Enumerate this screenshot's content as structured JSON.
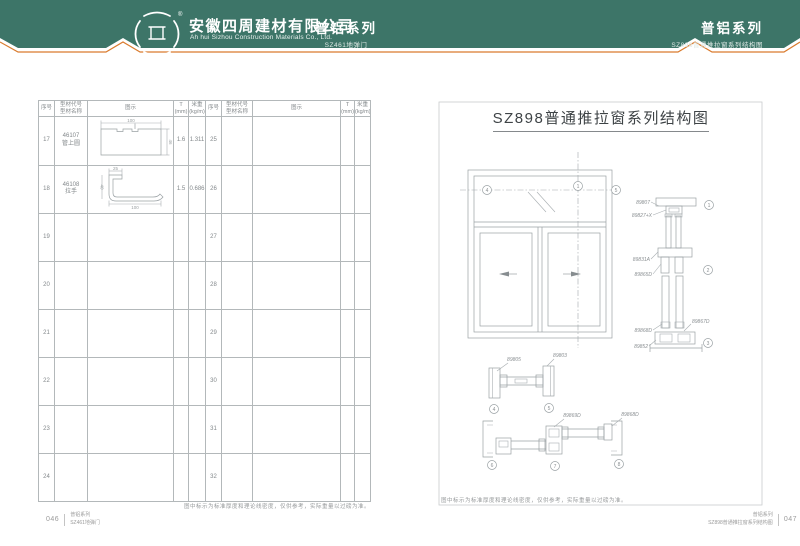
{
  "header": {
    "green": "#3D7568",
    "accent": "#D97B2E",
    "logo_registered": "®",
    "company_name": "安徽四周建材有限公司",
    "company_name_en": "Ah hui Sizhou Construction Materials Co., Ltd.",
    "center": {
      "series": "普铝系列",
      "sub": "SZ461地弹门"
    },
    "right": {
      "series": "普铝系列",
      "sub": "SZ898普通推拉窗系列结构图"
    }
  },
  "left_page": {
    "table": {
      "headers": {
        "no": "序号",
        "code": "型材代号",
        "name": "型材名称",
        "figure": "图示",
        "t1": "T",
        "t2": "(mm)",
        "w1": "米重",
        "w2": "(kg/m)"
      },
      "rows": [
        {
          "n1": "17",
          "code": "46107",
          "name": "管上圆",
          "t": "1.6",
          "w": "1.311",
          "n2": "25"
        },
        {
          "n1": "18",
          "code": "46108",
          "name": "拉手",
          "t": "1.5",
          "w": "0.686",
          "n2": "26"
        },
        {
          "n1": "19",
          "n2": "27"
        },
        {
          "n1": "20",
          "n2": "28"
        },
        {
          "n1": "21",
          "n2": "29"
        },
        {
          "n1": "22",
          "n2": "30"
        },
        {
          "n1": "23",
          "n2": "31"
        },
        {
          "n1": "24",
          "n2": "32"
        }
      ],
      "drawing_46107": {
        "dim_top": "100",
        "dim_right": "46"
      },
      "drawing_46108": {
        "dim_top": "25",
        "dim_left": "40",
        "dim_bottom": "100"
      }
    },
    "note": "图中标示为标准厚度和理论线密度，仅供参考，实际重量以过磅为准。",
    "footer": {
      "page": "046",
      "series": "普铝系列",
      "sub": "SZ461地弹门"
    }
  },
  "right_page": {
    "title": "SZ898普通推拉窗系列结构图",
    "parts": {
      "head_frame": "89807",
      "head_adapter": "89827+X",
      "interlock": "89831A",
      "sash_rail": "89865D",
      "bottom_rail": "89868D",
      "sill": "89852",
      "side_right": "89867D",
      "mid_left": "89805",
      "mid_right": "89803",
      "bottom_mid": "89869D",
      "bottom_right": "89868D"
    },
    "markers": {
      "m1": "1",
      "m2": "2",
      "m3": "3",
      "m4": "4",
      "m5": "5",
      "m6": "6",
      "m7": "7",
      "m8": "8"
    },
    "note": "图中标示为标准厚度和理论线密度，仅供参考，实际重量以过磅为准。",
    "footer": {
      "page": "047",
      "series": "普铝系列",
      "sub": "SZ898普通推拉窗系列结构图"
    }
  }
}
